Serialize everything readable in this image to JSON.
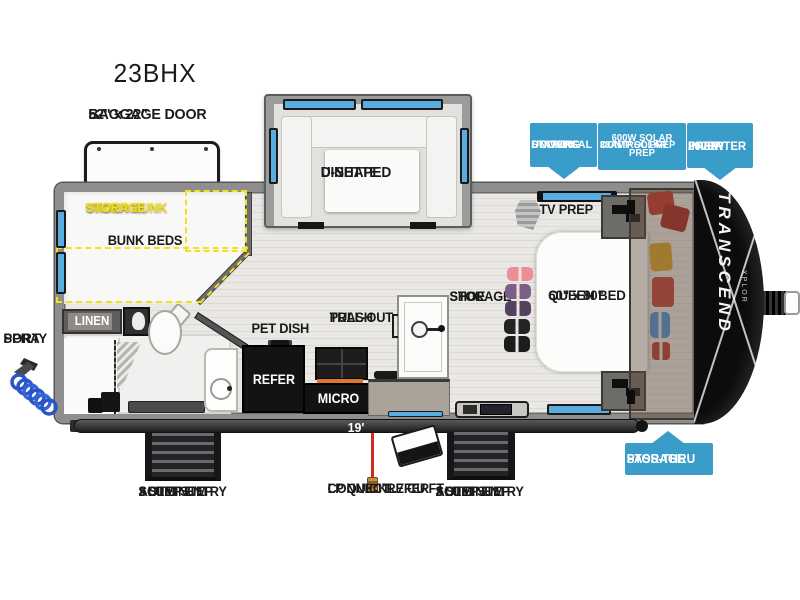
{
  "title": "23BHX",
  "colors": {
    "badge_blue": "#3a9cc9",
    "highlight_yellow": "#f2e11e",
    "window_blue": "#58ace0"
  },
  "labels": {
    "baggage_l1": "52\" x 22\"",
    "baggage_l2": "BAGGAGE DOOR",
    "dinette_l1": "U-SHAPED",
    "dinette_l2": "DINETTE",
    "under_bunk_l1": "UNDER BUNK",
    "under_bunk_l2": "STORAGE",
    "bunk_beds": "BUNK BEDS",
    "linen": "LINEN",
    "spray_l1": "SPRAY",
    "spray_l2": "PORT",
    "pet_dish": "PET DISH",
    "trash_l1": "PULL-OUT",
    "trash_l2": "TRASH",
    "refer": "REFER",
    "micro": "MICRO",
    "shoe_l1": "SHOE",
    "shoe_l2": "STORAGE",
    "bed_l1": "60\" x 80\"",
    "bed_l2": "QUEEN BED",
    "tv_prep": "TV PREP",
    "awning": "19' AWNING",
    "lp_l1": "LP QUICK",
    "lp_l2": "CONNECT",
    "ext_refer_l1": "1.7 CU FT",
    "ext_refer_l2": "REFER",
    "step_l1": "ALUMINUM",
    "step_l2": "SOLID STEP",
    "step_l3": "3 STEP ENTRY"
  },
  "badges": {
    "docking_l1": "UNIVERSAL",
    "docking_l2": "DOCKING",
    "docking_l3": "STATION",
    "solar_l1": "600W SOLAR PREP",
    "solar_l2": "30AMP SOLAR",
    "solar_l3": "CONTROL PREP",
    "inverter_l1": "2000W",
    "inverter_l2": "INVERTER",
    "inverter_l3": "PREP",
    "passthru_l1": "PASS-THRU",
    "passthru_l2": "STORAGE"
  },
  "brand": {
    "name": "TRANSCEND",
    "series": "XPLOR"
  }
}
